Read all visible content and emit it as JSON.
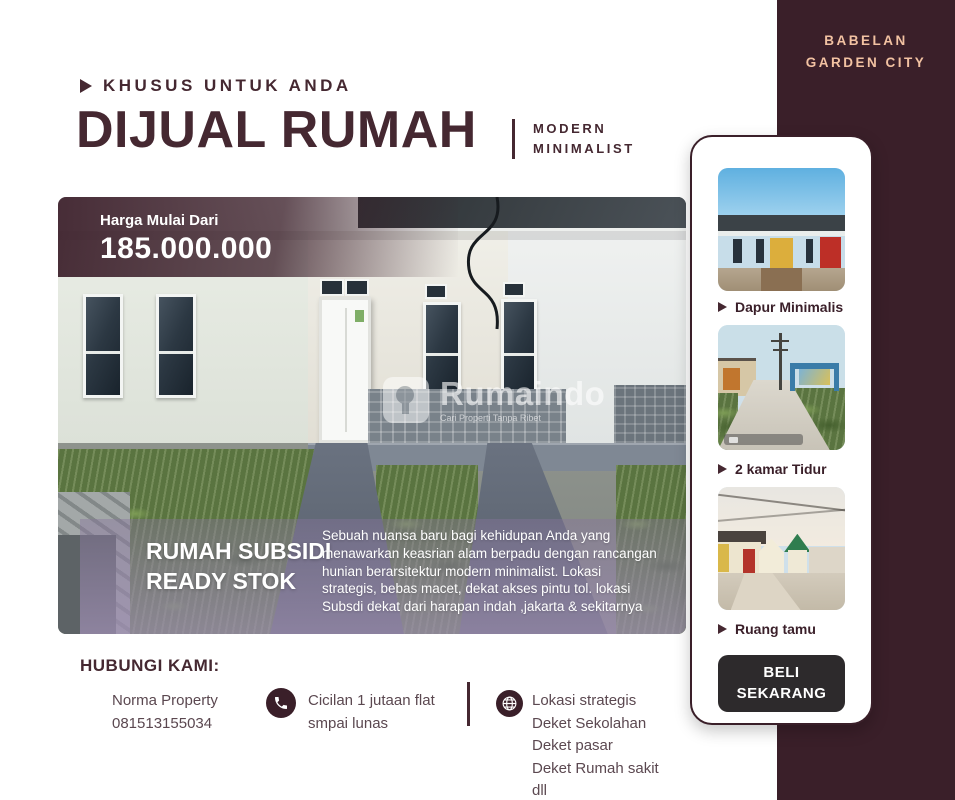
{
  "brand": {
    "title": "BABELAN GARDEN CITY"
  },
  "header": {
    "eyebrow": "KHUSUS UNTUK ANDA",
    "title": "DIJUAL RUMAH",
    "subtitle": "MODERN MINIMALIST"
  },
  "hero": {
    "price_label": "Harga Mulai Dari",
    "price_value": "185.000.000",
    "watermark": {
      "name": "Rumaindo",
      "tagline": "Cari Properti Tanpa Ribet"
    },
    "badge_line1": "RUMAH SUBSIDI",
    "badge_line2": "READY STOK",
    "description": "Sebuah nuansa baru bagi kehidupan Anda yang menawarkan keasrian alam berpadu dengan rancangan hunian berarsitektur modern minimalist. Lokasi strategis, bebas macet, dekat akses pintu tol. lokasi Subsdi dekat dari harapan indah ,jakarta & sekitarnya"
  },
  "gallery": {
    "items": [
      {
        "label": "Dapur Minimalis"
      },
      {
        "label": "2 kamar Tidur"
      },
      {
        "label": "Ruang tamu"
      }
    ],
    "cta_label": "BELI SEKARANG"
  },
  "contact": {
    "heading": "HUBUNGI KAMI:",
    "agent_name": "Norma Property",
    "agent_phone": "081513155034",
    "installment": "Cicilan 1 jutaan flat smpai lunas",
    "location_lines": [
      "Lokasi strategis",
      "Deket Sekolahan",
      "Deket pasar",
      "Deket Rumah sakit",
      "dll"
    ]
  },
  "colors": {
    "brand": "#3a1f29",
    "heading": "#452831",
    "peach": "#f2c2a2",
    "button": "#2d2a2c"
  }
}
